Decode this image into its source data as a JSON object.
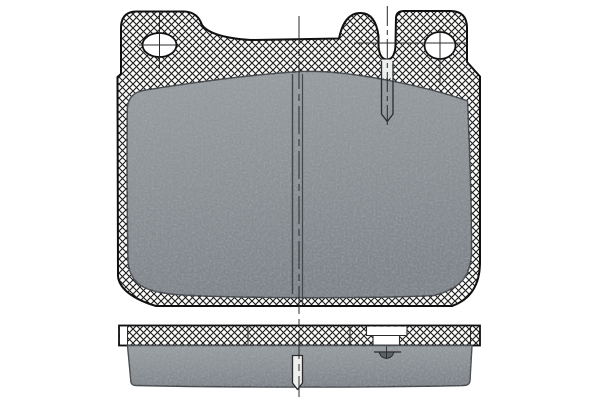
{
  "document": {
    "kind": "technical-parts-diagram",
    "subject": "disc-brake-pad",
    "views": {
      "front_view": "pad face with backing plate, two mounting holes, wear-sensor slot, center groove",
      "edge_view": "backing plate strip over friction material block with center groove and sensor section"
    }
  },
  "canvas": {
    "width": 600,
    "height": 400,
    "background": "#ffffff"
  },
  "colors": {
    "background": "#ffffff",
    "outline": "#101010",
    "hatch_line": "#1c1c1c",
    "hatch_bg": "#fcfcfb",
    "line": "#2b2b2b",
    "friction_light": "#989da1",
    "friction_mid": "#8a9094",
    "friction_dark": "#7d8388",
    "friction_edge": "#43474b",
    "slot_fill": "#eef0f0",
    "white": "#ffffff",
    "mark_fill": "#5c6165"
  },
  "drawing": {
    "shapes": [
      {
        "el": "path",
        "name": "backing-plate-front",
        "attrs": {
          "d": "M156,306 C134,299.5 119,289 118,276 L117.5,77 L121,74 L121,28 Q121,11.5 137,11.5 L184.5,11.5 Q197.5,12 202,25 C208.5,34 227,38.5 251,40 L339,38.5 C342.5,21.5 349.5,13 360.5,13 C370.5,13 376.5,21 378.5,36 L378.5,44 C378.5,53.5 381.5,59.5 387,59.5 C392.5,59.5 395.5,53.5 395.5,44 L396,17.5 Q396.5,11 404,11 L451,11 Q466.5,11.5 467,27 L467,62 L480,76.5 L480,262 Q480,296 452,306 Z",
          "fill": "url(#hatch)",
          "stroke": "$colors.outline",
          "stroke-width": 2,
          "stroke-linejoin": "round"
        }
      },
      {
        "el": "path",
        "name": "friction-material-front",
        "attrs": {
          "d": "M127.3,108 C128.5,97 134,92.5 143,90.5 C190,83 250,74.5 302,71.5 C352,69.5 433,88.5 467.5,101 C469.5,146 471.5,208 471.5,250 C471.5,277.5 459,289 434,295.5 C372,298.5 246,298.5 183,295 C148.5,293 128.5,286.5 128,259 C127,210 127,150 127.3,108 Z",
          "fill": "url(#fricGrad)",
          "stroke": "$colors.friction_edge",
          "stroke-width": 1.5,
          "stroke-linejoin": "round"
        }
      },
      {
        "el": "path",
        "name": "friction-material-front-texture",
        "attrs": {
          "d": "M127.3,108 C128.5,97 134,92.5 143,90.5 C190,83 250,74.5 302,71.5 C352,69.5 433,88.5 467.5,101 C469.5,146 471.5,208 471.5,250 C471.5,277.5 459,289 434,295.5 C372,298.5 246,298.5 183,295 C148.5,293 128.5,286.5 128,259 C127,210 127,150 127.3,108 Z",
          "fill": "#ffffff",
          "filter": "url(#grain)",
          "opacity": 0.5
        }
      },
      {
        "el": "line",
        "name": "center-groove-left-line",
        "attrs": {
          "x1": 292.5,
          "y1": 74,
          "x2": 292.5,
          "y2": 294,
          "stroke": "$colors.friction_edge",
          "stroke-width": 1.4
        }
      },
      {
        "el": "line",
        "name": "center-groove-right-line",
        "attrs": {
          "x1": 302.5,
          "y1": 74,
          "x2": 302.5,
          "y2": 305,
          "stroke": "$colors.friction_edge",
          "stroke-width": 1.2
        }
      },
      {
        "el": "rect",
        "name": "wear-sensor-slot-opening",
        "attrs": {
          "x": 381.5,
          "y": 59.5,
          "width": 11.5,
          "height": 19,
          "fill": "$colors.slot_fill"
        }
      },
      {
        "el": "path",
        "name": "wear-sensor-slot",
        "attrs": {
          "d": "M381.5,61 L381.5,114 L387.3,121.5 L393,114 L393,61",
          "fill": "none",
          "stroke": "$colors.line",
          "stroke-width": 1.3,
          "stroke-linejoin": "round"
        }
      },
      {
        "el": "ellipse",
        "name": "mounting-hole-left",
        "attrs": {
          "cx": 159.5,
          "cy": 45,
          "rx": 17,
          "ry": 12,
          "fill": "$colors.white",
          "stroke": "$colors.outline",
          "stroke-width": 1.8
        }
      },
      {
        "el": "ellipse",
        "name": "mounting-hole-right",
        "attrs": {
          "cx": 440,
          "cy": 45.5,
          "rx": 15.5,
          "ry": 13.5,
          "fill": "$colors.white",
          "stroke": "$colors.outline",
          "stroke-width": 1.8
        }
      },
      {
        "el": "line",
        "name": "left-hole-crosshair-vertical",
        "attrs": {
          "x1": 159.5,
          "y1": 11.5,
          "x2": 159.5,
          "y2": 68,
          "stroke": "$colors.line",
          "stroke-width": 1
        }
      },
      {
        "el": "line",
        "name": "left-hole-crosshair-horizontal",
        "attrs": {
          "x1": 139,
          "y1": 45,
          "x2": 180,
          "y2": 45,
          "stroke": "$colors.line",
          "stroke-width": 1
        }
      },
      {
        "el": "line",
        "name": "right-hole-crosshair-vertical",
        "attrs": {
          "x1": 440,
          "y1": 29,
          "x2": 440,
          "y2": 86,
          "stroke": "$colors.line",
          "stroke-width": 1
        }
      },
      {
        "el": "line",
        "name": "right-hole-crosshair-horizontal",
        "attrs": {
          "x1": 354,
          "y1": 43,
          "x2": 467,
          "y2": 43,
          "stroke": "$colors.line",
          "stroke-width": 1
        }
      },
      {
        "el": "line",
        "name": "sensor-slot-centerline",
        "attrs": {
          "x1": 387.3,
          "y1": 6,
          "x2": 387.3,
          "y2": 128,
          "stroke": "$colors.line",
          "stroke-width": 1,
          "stroke-dasharray": "20 4 5 4"
        }
      },
      {
        "el": "rect",
        "name": "backing-plate-edge",
        "attrs": {
          "x": 119,
          "y": 325.5,
          "width": 361,
          "height": 20,
          "fill": "url(#hatch)"
        }
      },
      {
        "el": "rect",
        "name": "backing-plate-edge-left-cap",
        "attrs": {
          "x": 119.8,
          "y": 326.3,
          "width": 7.6,
          "height": 18.4,
          "fill": "$colors.white"
        }
      },
      {
        "el": "rect",
        "name": "sensor-notch-outer",
        "attrs": {
          "x": 366.5,
          "y": 326.6,
          "width": 40.5,
          "height": 8.9,
          "fill": "$colors.white"
        }
      },
      {
        "el": "rect",
        "name": "sensor-notch-inner",
        "attrs": {
          "x": 373,
          "y": 335.5,
          "width": 26.5,
          "height": 9.6,
          "fill": "$colors.white"
        }
      },
      {
        "el": "path",
        "name": "sensor-notch-outline",
        "attrs": {
          "d": "M366.5,326.5 L366.5,335.5 L407,335.5 L407,326.5 M373,335.5 L373,345 M399.5,335.5 L399.5,345",
          "fill": "none",
          "stroke": "$colors.line",
          "stroke-width": 1.1
        }
      },
      {
        "el": "rect",
        "name": "backing-plate-edge-outline",
        "attrs": {
          "x": 119,
          "y": 325.5,
          "width": 361,
          "height": 20,
          "fill": "none",
          "stroke": "$colors.outline",
          "stroke-width": 1.8
        }
      },
      {
        "el": "line",
        "name": "plate-joint-line-1",
        "attrs": {
          "x1": 127.5,
          "y1": 325.5,
          "x2": 127.5,
          "y2": 345.5,
          "stroke": "$colors.line",
          "stroke-width": 1
        }
      },
      {
        "el": "line",
        "name": "plate-joint-line-2",
        "attrs": {
          "x1": 248,
          "y1": 325.5,
          "x2": 248,
          "y2": 345.5,
          "stroke": "$colors.line",
          "stroke-width": 1
        }
      },
      {
        "el": "line",
        "name": "plate-joint-line-3",
        "attrs": {
          "x1": 350,
          "y1": 325.5,
          "x2": 350,
          "y2": 345.5,
          "stroke": "$colors.line",
          "stroke-width": 1
        }
      },
      {
        "el": "line",
        "name": "plate-joint-line-4",
        "attrs": {
          "x1": 470.5,
          "y1": 325.5,
          "x2": 470.5,
          "y2": 345.5,
          "stroke": "$colors.line",
          "stroke-width": 1
        }
      },
      {
        "el": "path",
        "name": "friction-material-edge",
        "attrs": {
          "d": "M127.5,345.5 L472,345.5 L470,380.5 Q469.5,385.5 463.5,385.5 C381,387.6 221,387.6 136.5,385.5 Q130.8,385.5 130.8,380.5 Z",
          "fill": "url(#fricGrad)",
          "stroke": "$colors.friction_edge",
          "stroke-width": 1.4,
          "stroke-linejoin": "round"
        }
      },
      {
        "el": "path",
        "name": "friction-material-edge-texture",
        "attrs": {
          "d": "M127.5,345.5 L472,345.5 L470,380.5 Q469.5,385.5 463.5,385.5 C381,387.6 221,387.6 136.5,385.5 Q130.8,385.5 130.8,380.5 Z",
          "fill": "#ffffff",
          "filter": "url(#grain)",
          "opacity": 0.5
        }
      },
      {
        "el": "path",
        "name": "center-groove-edge",
        "attrs": {
          "d": "M292.5,355.5 L292.5,383 L297.5,389.5 L302.5,383 L302.5,355.5 Z",
          "fill": "$colors.slot_fill",
          "stroke": "$colors.line",
          "stroke-width": 1.3,
          "stroke-linejoin": "round"
        }
      },
      {
        "el": "line",
        "name": "sensor-section-line",
        "attrs": {
          "x1": 374,
          "y1": 352,
          "x2": 401,
          "y2": 352,
          "stroke": "$colors.line",
          "stroke-width": 1.2
        }
      },
      {
        "el": "path",
        "name": "sensor-section-mark",
        "attrs": {
          "d": "M379.5,352 A7,6.2 0 0 0 393.5,352 Z",
          "fill": "$colors.mark_fill",
          "stroke": "$colors.line",
          "stroke-width": 1
        }
      },
      {
        "el": "line",
        "name": "sensor-section-centerline",
        "attrs": {
          "x1": 386.5,
          "y1": 346.5,
          "x2": 386.5,
          "y2": 359,
          "stroke": "$colors.line",
          "stroke-width": 0.9
        }
      },
      {
        "el": "line",
        "name": "vertical-centerline",
        "attrs": {
          "x1": 299,
          "y1": 16,
          "x2": 299,
          "y2": 397,
          "stroke": "$colors.line",
          "stroke-width": 1,
          "stroke-dasharray": "28 5 7 5"
        }
      }
    ]
  }
}
